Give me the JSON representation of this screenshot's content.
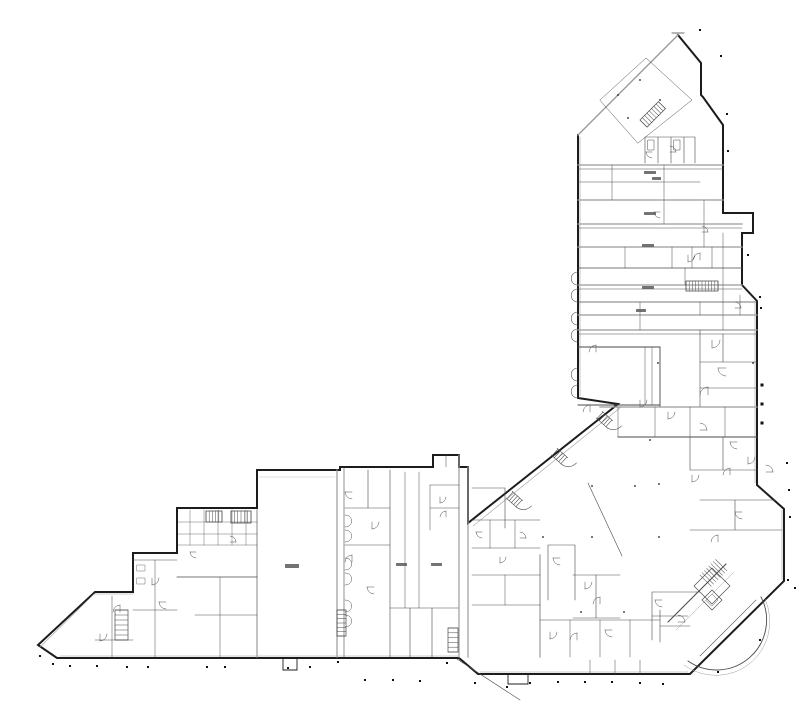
{
  "figure": {
    "kind": "building-floor-plan",
    "background": "#ffffff",
    "width": 800,
    "height": 718
  },
  "palette": {
    "wall": "#1c1c1c",
    "partition": "#4a4a4a",
    "light": "#9b9b9b",
    "faint": "#c4c4c4",
    "dot": "#111111",
    "smudge": "#5a5a5a"
  },
  "drawing": {
    "paths": [
      {
        "d": "M678,35 L701,63 L701,95 L703,97 L723,125 L723,213 L753,213 L753,233 L742,233 L742,285 L757,301 L757,485 L784,509 L784,581 L690,674 L478,674 L459,658 L57,658 L38,645 L95,592 L133,592 L133,553 L177,553 L177,508 L257,508 L257,470 L340,470 L340,467 L433,467 L433,455 L459,455 L459,467 L468,467 L468,523 L618,404 L578,398 L578,135",
        "w": 2,
        "c": "wall"
      },
      {
        "d": "M578,135 L678,35",
        "w": 1.4,
        "c": "light"
      },
      {
        "d": "M672,33 L684,33",
        "w": 0.8,
        "c": "partition"
      },
      {
        "d": "M60,656 L458,656",
        "w": 0.6,
        "c": "light"
      },
      {
        "d": "M480,672 L688,672",
        "w": 0.6,
        "c": "light"
      },
      {
        "d": "M580,137 L580,396",
        "w": 0.6,
        "c": "light"
      },
      {
        "d": "M755,303 L755,483",
        "w": 0.6,
        "c": "light"
      },
      {
        "d": "M782,510 L782,580",
        "w": 0.6,
        "c": "light"
      },
      {
        "d": "M621,407 L473,526",
        "w": 0.6,
        "c": "light"
      },
      {
        "d": "M40,647 L94,594 L133,594",
        "w": 0.6,
        "c": "light"
      },
      {
        "d": "M578,165 L723,165",
        "w": 1.3,
        "c": "light"
      },
      {
        "d": "M578,169 L723,169",
        "w": 0.5,
        "c": "partition"
      },
      {
        "d": "M578,182 L700,182",
        "w": 0.5,
        "c": "partition"
      },
      {
        "d": "M578,200 L723,200",
        "w": 1.3,
        "c": "light"
      },
      {
        "d": "M578,224 L742,224",
        "w": 1.3,
        "c": "light"
      },
      {
        "d": "M578,228 L742,228",
        "w": 0.5,
        "c": "partition"
      },
      {
        "d": "M578,247 L742,247",
        "w": 1.3,
        "c": "light"
      },
      {
        "d": "M578,268 L742,268",
        "w": 0.8,
        "c": "partition"
      },
      {
        "d": "M578,285 L742,285",
        "w": 1.3,
        "c": "light"
      },
      {
        "d": "M578,289 L742,289",
        "w": 0.5,
        "c": "partition"
      },
      {
        "d": "M578,302 L757,302",
        "w": 0.8,
        "c": "partition"
      },
      {
        "d": "M578,315 L757,315",
        "w": 1.3,
        "c": "light"
      },
      {
        "d": "M578,330 L757,330",
        "w": 1.3,
        "c": "light"
      },
      {
        "d": "M578,334 L757,334",
        "w": 0.5,
        "c": "partition"
      },
      {
        "d": "M612,165 L612,200 M664,165 L664,224 M704,200 L704,247 M625,247 L625,268 M685,268 L685,285 M640,302 L640,330 M723,233 L723,330",
        "w": 0.5,
        "c": "partition"
      },
      {
        "d": "M600,100 L646,58 L692,100 L638,143 Z",
        "w": 0.5,
        "c": "partition"
      },
      {
        "d": "M645,137 L645,163 M658,137 L658,163 M671,137 L671,163 M684,137 L684,163 M695,137 L695,163 M645,137 L695,137",
        "w": 0.6,
        "c": "partition"
      },
      {
        "d": "M648,140 L654,140 L654,150 L648,150 Z M674,140 L680,140 L680,150 L674,150 Z",
        "w": 0.5,
        "c": "partition"
      },
      {
        "d": "M672,247 L672,268 M692,247 L692,268 M712,247 L712,268",
        "w": 0.5,
        "c": "partition"
      },
      {
        "d": "M740,295 L740,315 M700,302 L700,315",
        "w": 0.5,
        "c": "partition"
      },
      {
        "d": "M700,330 L700,407 M700,362 L757,362 M723,334 L723,362 M700,388 L757,388",
        "w": 0.6,
        "c": "partition"
      },
      {
        "d": "M578,347 L660,347 L660,407",
        "w": 0.9,
        "c": "partition"
      },
      {
        "d": "M645,347 L645,405 M652,347 L652,405",
        "w": 0.5,
        "c": "partition"
      },
      {
        "d": "M578,405 L660,405",
        "w": 0.9,
        "c": "partition"
      },
      {
        "d": "M600,407 L757,407",
        "w": 1.3,
        "c": "light"
      },
      {
        "d": "M618,407 L618,437 M655,407 L655,437 M690,407 L690,437 M725,407 L725,437",
        "w": 0.5,
        "c": "partition"
      },
      {
        "d": "M618,437 L757,437",
        "w": 0.9,
        "c": "partition"
      },
      {
        "d": "M690,437 L690,470 M690,470 L757,470 M723,437 L723,470",
        "w": 0.6,
        "c": "partition"
      },
      {
        "d": "M578,272 c-9,0 -9,13 0,13 M578,289 c-9,0 -9,13 0,13 M578,312 c-9,0 -9,13 0,13 M578,329 c-9,0 -9,13 0,13 M578,368 c-9,0 -9,13 0,13 M578,385 c-9,0 -9,13 0,13",
        "w": 0.6,
        "c": "partition"
      },
      {
        "d": "M588,483 L622,556",
        "w": 0.6,
        "c": "partition"
      },
      {
        "d": "M548,545 L575,545 L575,600 M548,545 L548,600",
        "w": 0.6,
        "c": "partition"
      },
      {
        "d": "M573,575 L620,575 M596,575 L596,618 M573,618 L620,618",
        "w": 0.6,
        "c": "partition"
      },
      {
        "d": "M652,592 L700,592 M652,592 L652,640 M652,616 L688,616",
        "w": 0.6,
        "c": "partition"
      },
      {
        "d": "M590,660 L590,674 M615,660 L615,674 M640,660 L640,674",
        "w": 0.5,
        "c": "partition"
      },
      {
        "d": "M508,674 L508,684 L528,684 L528,674",
        "w": 0.9,
        "c": "wall"
      },
      {
        "d": "M457,659 L520,700",
        "w": 0.6,
        "c": "partition"
      },
      {
        "d": "M700,500 L775,500 M735,500 L735,530 M690,530 L782,530",
        "w": 0.6,
        "c": "partition"
      },
      {
        "d": "M668,622 L726,564",
        "w": 1.0,
        "c": "partition"
      },
      {
        "d": "M676,630 L734,572",
        "w": 0.5,
        "c": "light"
      },
      {
        "d": "M700,656 L756,600",
        "w": 0.6,
        "c": "partition"
      },
      {
        "d": "M688,661 A50,50 0 0 0 761,597",
        "w": 0.9,
        "c": "partition"
      },
      {
        "d": "M684,665 A54,54 0 0 0 765,599",
        "w": 0.5,
        "c": "light"
      },
      {
        "d": "M694,586 L712,568 L730,586 L712,604 Z",
        "w": 0.7,
        "c": "partition"
      },
      {
        "d": "M702,600 L712,590 L722,600 L712,610 Z",
        "w": 0.7,
        "c": "partition"
      },
      {
        "d": "M706,600 L712,594 L718,600 L712,606 Z",
        "w": 0.5,
        "c": "partition"
      },
      {
        "d": "M660,610 L660,642 M660,626 L690,626",
        "w": 0.6,
        "c": "partition"
      },
      {
        "d": "M259,477 L335,477",
        "w": 0.5,
        "c": "faint"
      },
      {
        "d": "M283,658 L283,670 L297,670 L297,658",
        "w": 0.9,
        "c": "wall"
      },
      {
        "d": "M257,510 L257,657",
        "w": 1.2,
        "c": "light"
      },
      {
        "d": "M337,470 L337,657",
        "w": 1.2,
        "c": "light"
      },
      {
        "d": "M344,467 L344,657",
        "w": 0.6,
        "c": "partition"
      },
      {
        "d": "M177,577 L257,577",
        "w": 0.8,
        "c": "partition"
      },
      {
        "d": "M190,510 L190,545 M204,510 L204,545 M218,510 L218,545 M232,510 L232,545 M246,510 L246,545",
        "w": 0.4,
        "c": "partition"
      },
      {
        "d": "M178,522 L257,522 M178,534 L257,534 M178,545 L257,545",
        "w": 0.4,
        "c": "partition"
      },
      {
        "d": "M220,577 L220,657 M195,615 L257,615",
        "w": 0.5,
        "c": "partition"
      },
      {
        "d": "M133,560 L177,560 M155,560 L155,657 M133,610 L177,610",
        "w": 0.5,
        "c": "partition"
      },
      {
        "d": "M137,565 L145,565 L145,571 L137,571 Z M137,578 L145,578 L145,584 L137,584 Z",
        "w": 0.4,
        "c": "partition"
      },
      {
        "d": "M112,596 L112,657 M95,640 L133,640",
        "w": 0.5,
        "c": "partition"
      },
      {
        "d": "M345,508 L390,508 M345,545 L390,545 M368,470 L368,508 M390,470 L390,657",
        "w": 0.6,
        "c": "partition"
      },
      {
        "d": "M345,515 c9,0 9,12 0,12 M345,530 c9,0 9,12 0,12 M345,558 c9,0 9,12 0,12 M345,573 c9,0 9,12 0,12 M345,600 c9,0 9,12 0,12 M345,615 c9,0 9,12 0,12",
        "w": 0.5,
        "c": "partition"
      },
      {
        "d": "M405,472 L405,608 M419,472 L419,608",
        "w": 0.5,
        "c": "partition"
      },
      {
        "d": "M390,608 L459,608 M410,608 L410,657 M432,608 L432,657",
        "w": 0.6,
        "c": "partition"
      },
      {
        "d": "M459,455 L459,657",
        "w": 1.2,
        "c": "light"
      },
      {
        "d": "M430,485 L459,485 M430,485 L430,530 M430,508 L459,508 M446,455 L446,467",
        "w": 0.5,
        "c": "partition"
      },
      {
        "d": "M468,467 L468,657",
        "w": 1.2,
        "c": "light"
      },
      {
        "d": "M540,555 L540,657",
        "w": 1.2,
        "c": "light"
      },
      {
        "d": "M472,520 L540,520 M490,520 L490,548 M515,520 L515,548 M472,548 L540,548",
        "w": 0.5,
        "c": "partition"
      },
      {
        "d": "M472,488 L505,488 L505,528",
        "w": 0.6,
        "c": "partition"
      },
      {
        "d": "M472,575 L540,575 M472,605 L540,605 M505,575 L505,605",
        "w": 0.5,
        "c": "partition"
      },
      {
        "d": "M540,620 L660,620 M570,620 L570,657 M600,620 L600,657 M630,620 L630,657",
        "w": 0.5,
        "c": "partition"
      }
    ],
    "hatches": [
      {
        "x": 640,
        "y": 120,
        "w": 26,
        "h": 10,
        "n": 9,
        "dir": "v",
        "rot": -45,
        "box": true
      },
      {
        "x": 686,
        "y": 281,
        "w": 32,
        "h": 10,
        "n": 11,
        "dir": "v",
        "rot": 0,
        "box": true
      },
      {
        "x": 337,
        "y": 610,
        "w": 9,
        "h": 26,
        "n": 7,
        "dir": "h",
        "rot": 0,
        "box": true
      },
      {
        "x": 115,
        "y": 610,
        "w": 13,
        "h": 30,
        "n": 7,
        "dir": "h",
        "rot": 0,
        "box": true
      },
      {
        "x": 700,
        "y": 575,
        "w": 22,
        "h": 16,
        "n": 8,
        "dir": "v",
        "rot": -45,
        "box": false
      },
      {
        "x": 206,
        "y": 511,
        "w": 16,
        "h": 11,
        "n": 6,
        "dir": "v",
        "rot": 0,
        "box": true
      },
      {
        "x": 231,
        "y": 511,
        "w": 20,
        "h": 12,
        "n": 7,
        "dir": "v",
        "rot": 0,
        "box": true
      },
      {
        "x": 448,
        "y": 628,
        "w": 10,
        "h": 24,
        "n": 6,
        "dir": "h",
        "rot": 0,
        "box": true
      }
    ],
    "canopies": [
      {
        "x": 603,
        "y": 412,
        "rot": 42
      },
      {
        "x": 558,
        "y": 449,
        "rot": 42
      },
      {
        "x": 513,
        "y": 492,
        "rot": 42
      }
    ],
    "doors": [
      [
        652,
        152,
        90,
        6
      ],
      [
        670,
        152,
        270,
        6
      ],
      [
        688,
        255,
        0,
        7
      ],
      [
        700,
        260,
        180,
        7
      ],
      [
        735,
        308,
        270,
        6
      ],
      [
        712,
        340,
        0,
        8
      ],
      [
        726,
        368,
        90,
        8
      ],
      [
        708,
        395,
        180,
        8
      ],
      [
        668,
        412,
        0,
        7
      ],
      [
        700,
        430,
        270,
        7
      ],
      [
        737,
        442,
        90,
        7
      ],
      [
        596,
        352,
        180,
        7
      ],
      [
        640,
        400,
        0,
        7
      ],
      [
        590,
        412,
        180,
        7
      ],
      [
        560,
        558,
        90,
        7
      ],
      [
        585,
        582,
        0,
        7
      ],
      [
        600,
        604,
        180,
        7
      ],
      [
        662,
        600,
        90,
        7
      ],
      [
        678,
        622,
        270,
        7
      ],
      [
        550,
        632,
        0,
        7
      ],
      [
        577,
        640,
        180,
        7
      ],
      [
        612,
        630,
        90,
        7
      ],
      [
        152,
        578,
        0,
        7
      ],
      [
        166,
        602,
        90,
        7
      ],
      [
        120,
        612,
        180,
        7
      ],
      [
        100,
        634,
        0,
        7
      ],
      [
        230,
        542,
        270,
        6
      ],
      [
        196,
        552,
        90,
        6
      ],
      [
        352,
        492,
        90,
        7
      ],
      [
        372,
        522,
        0,
        7
      ],
      [
        352,
        562,
        180,
        7
      ],
      [
        374,
        587,
        90,
        7
      ],
      [
        440,
        497,
        0,
        6
      ],
      [
        446,
        517,
        180,
        6
      ],
      [
        482,
        532,
        90,
        6
      ],
      [
        520,
        538,
        270,
        6
      ],
      [
        500,
        557,
        0,
        6
      ],
      [
        718,
        542,
        180,
        7
      ],
      [
        742,
        512,
        90,
        7
      ],
      [
        766,
        472,
        270,
        7
      ],
      [
        748,
        457,
        0,
        7
      ],
      [
        660,
        212,
        90,
        6
      ],
      [
        702,
        232,
        270,
        6
      ],
      [
        692,
        475,
        0,
        7
      ],
      [
        730,
        475,
        180,
        7
      ]
    ],
    "dots": [
      [
        700,
        30,
        2
      ],
      [
        721,
        56,
        2
      ],
      [
        727,
        114,
        2
      ],
      [
        728,
        151,
        2
      ],
      [
        748,
        255,
        2
      ],
      [
        760,
        297,
        2
      ],
      [
        761,
        308,
        2
      ],
      [
        762,
        385,
        3
      ],
      [
        762,
        404,
        3
      ],
      [
        762,
        423,
        3
      ],
      [
        787,
        463,
        2
      ],
      [
        789,
        490,
        2
      ],
      [
        790,
        517,
        2
      ],
      [
        788,
        580,
        2
      ],
      [
        795,
        588,
        2
      ],
      [
        760,
        640,
        2
      ],
      [
        718,
        672,
        2
      ],
      [
        53,
        664,
        2
      ],
      [
        70,
        666,
        2
      ],
      [
        97,
        666,
        2
      ],
      [
        127,
        667,
        2
      ],
      [
        148,
        667,
        2
      ],
      [
        207,
        667,
        2
      ],
      [
        225,
        667,
        2
      ],
      [
        288,
        668,
        2
      ],
      [
        310,
        667,
        2
      ],
      [
        338,
        662,
        2
      ],
      [
        365,
        680,
        2
      ],
      [
        393,
        680,
        2
      ],
      [
        420,
        681,
        2
      ],
      [
        447,
        663,
        2
      ],
      [
        475,
        683,
        2
      ],
      [
        507,
        687,
        2
      ],
      [
        530,
        683,
        2
      ],
      [
        558,
        682,
        2
      ],
      [
        585,
        682,
        2
      ],
      [
        612,
        682,
        2
      ],
      [
        640,
        683,
        2
      ],
      [
        663,
        684,
        2
      ],
      [
        40,
        656,
        2
      ],
      [
        592,
        486,
        1.5
      ],
      [
        635,
        486,
        1.5
      ],
      [
        659,
        484,
        1.5
      ],
      [
        543,
        537,
        1.5
      ],
      [
        592,
        537,
        1.5
      ],
      [
        659,
        537,
        1.5
      ],
      [
        581,
        612,
        1.5
      ],
      [
        624,
        612,
        1.5
      ],
      [
        618,
        95,
        1.5
      ],
      [
        640,
        80,
        1.5
      ],
      [
        660,
        100,
        1.5
      ],
      [
        628,
        118,
        1.5
      ],
      [
        658,
        363,
        1.5
      ],
      [
        753,
        363,
        1.5
      ],
      [
        650,
        440,
        1.5
      ]
    ],
    "smudges": [
      [
        644,
        171,
        12,
        3
      ],
      [
        644,
        212,
        12,
        3
      ],
      [
        642,
        244,
        12,
        3
      ],
      [
        642,
        286,
        12,
        3
      ],
      [
        636,
        309,
        10,
        3
      ],
      [
        285,
        564,
        14,
        4
      ],
      [
        396,
        563,
        11,
        3
      ],
      [
        431,
        563,
        11,
        3
      ],
      [
        652,
        177,
        9,
        3
      ]
    ]
  }
}
